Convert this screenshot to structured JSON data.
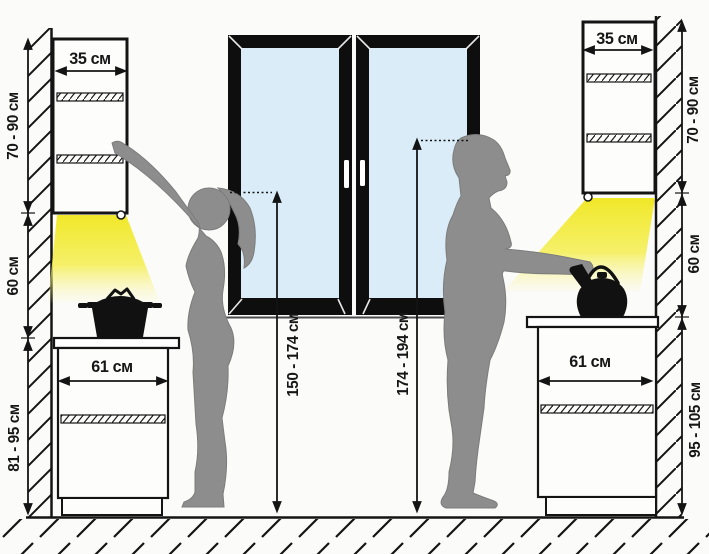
{
  "diagram": {
    "title": "Kitchen cabinet and worktop height ergonomics",
    "unit_labels": {
      "left_upper_width": "35 см",
      "left_upper_height": "70 - 90 см",
      "left_gap_height": "60 см",
      "left_base_width": "61 см",
      "left_base_height": "81 - 95 см",
      "woman_reach_height": "150 - 174 см",
      "man_reach_height": "174 - 194 см",
      "right_upper_width": "35 см",
      "right_upper_height": "70 - 90 см",
      "right_gap_height": "60 см",
      "right_base_width": "61 см",
      "right_base_height": "95 - 105 см"
    },
    "scene": {
      "figures": [
        "woman-silhouette",
        "man-silhouette"
      ],
      "objects": [
        "window",
        "pot-icon",
        "kettle-icon",
        "under-cabinet-light-left",
        "under-cabinet-light-right",
        "wall-hatching",
        "floor-hatching"
      ]
    },
    "colors": {
      "line": "#141414",
      "silhouette": "#8d8d8d",
      "window_glass": "#d9ecf7",
      "light_beam": "#f0e71f",
      "background": "#fbfbf9"
    }
  }
}
